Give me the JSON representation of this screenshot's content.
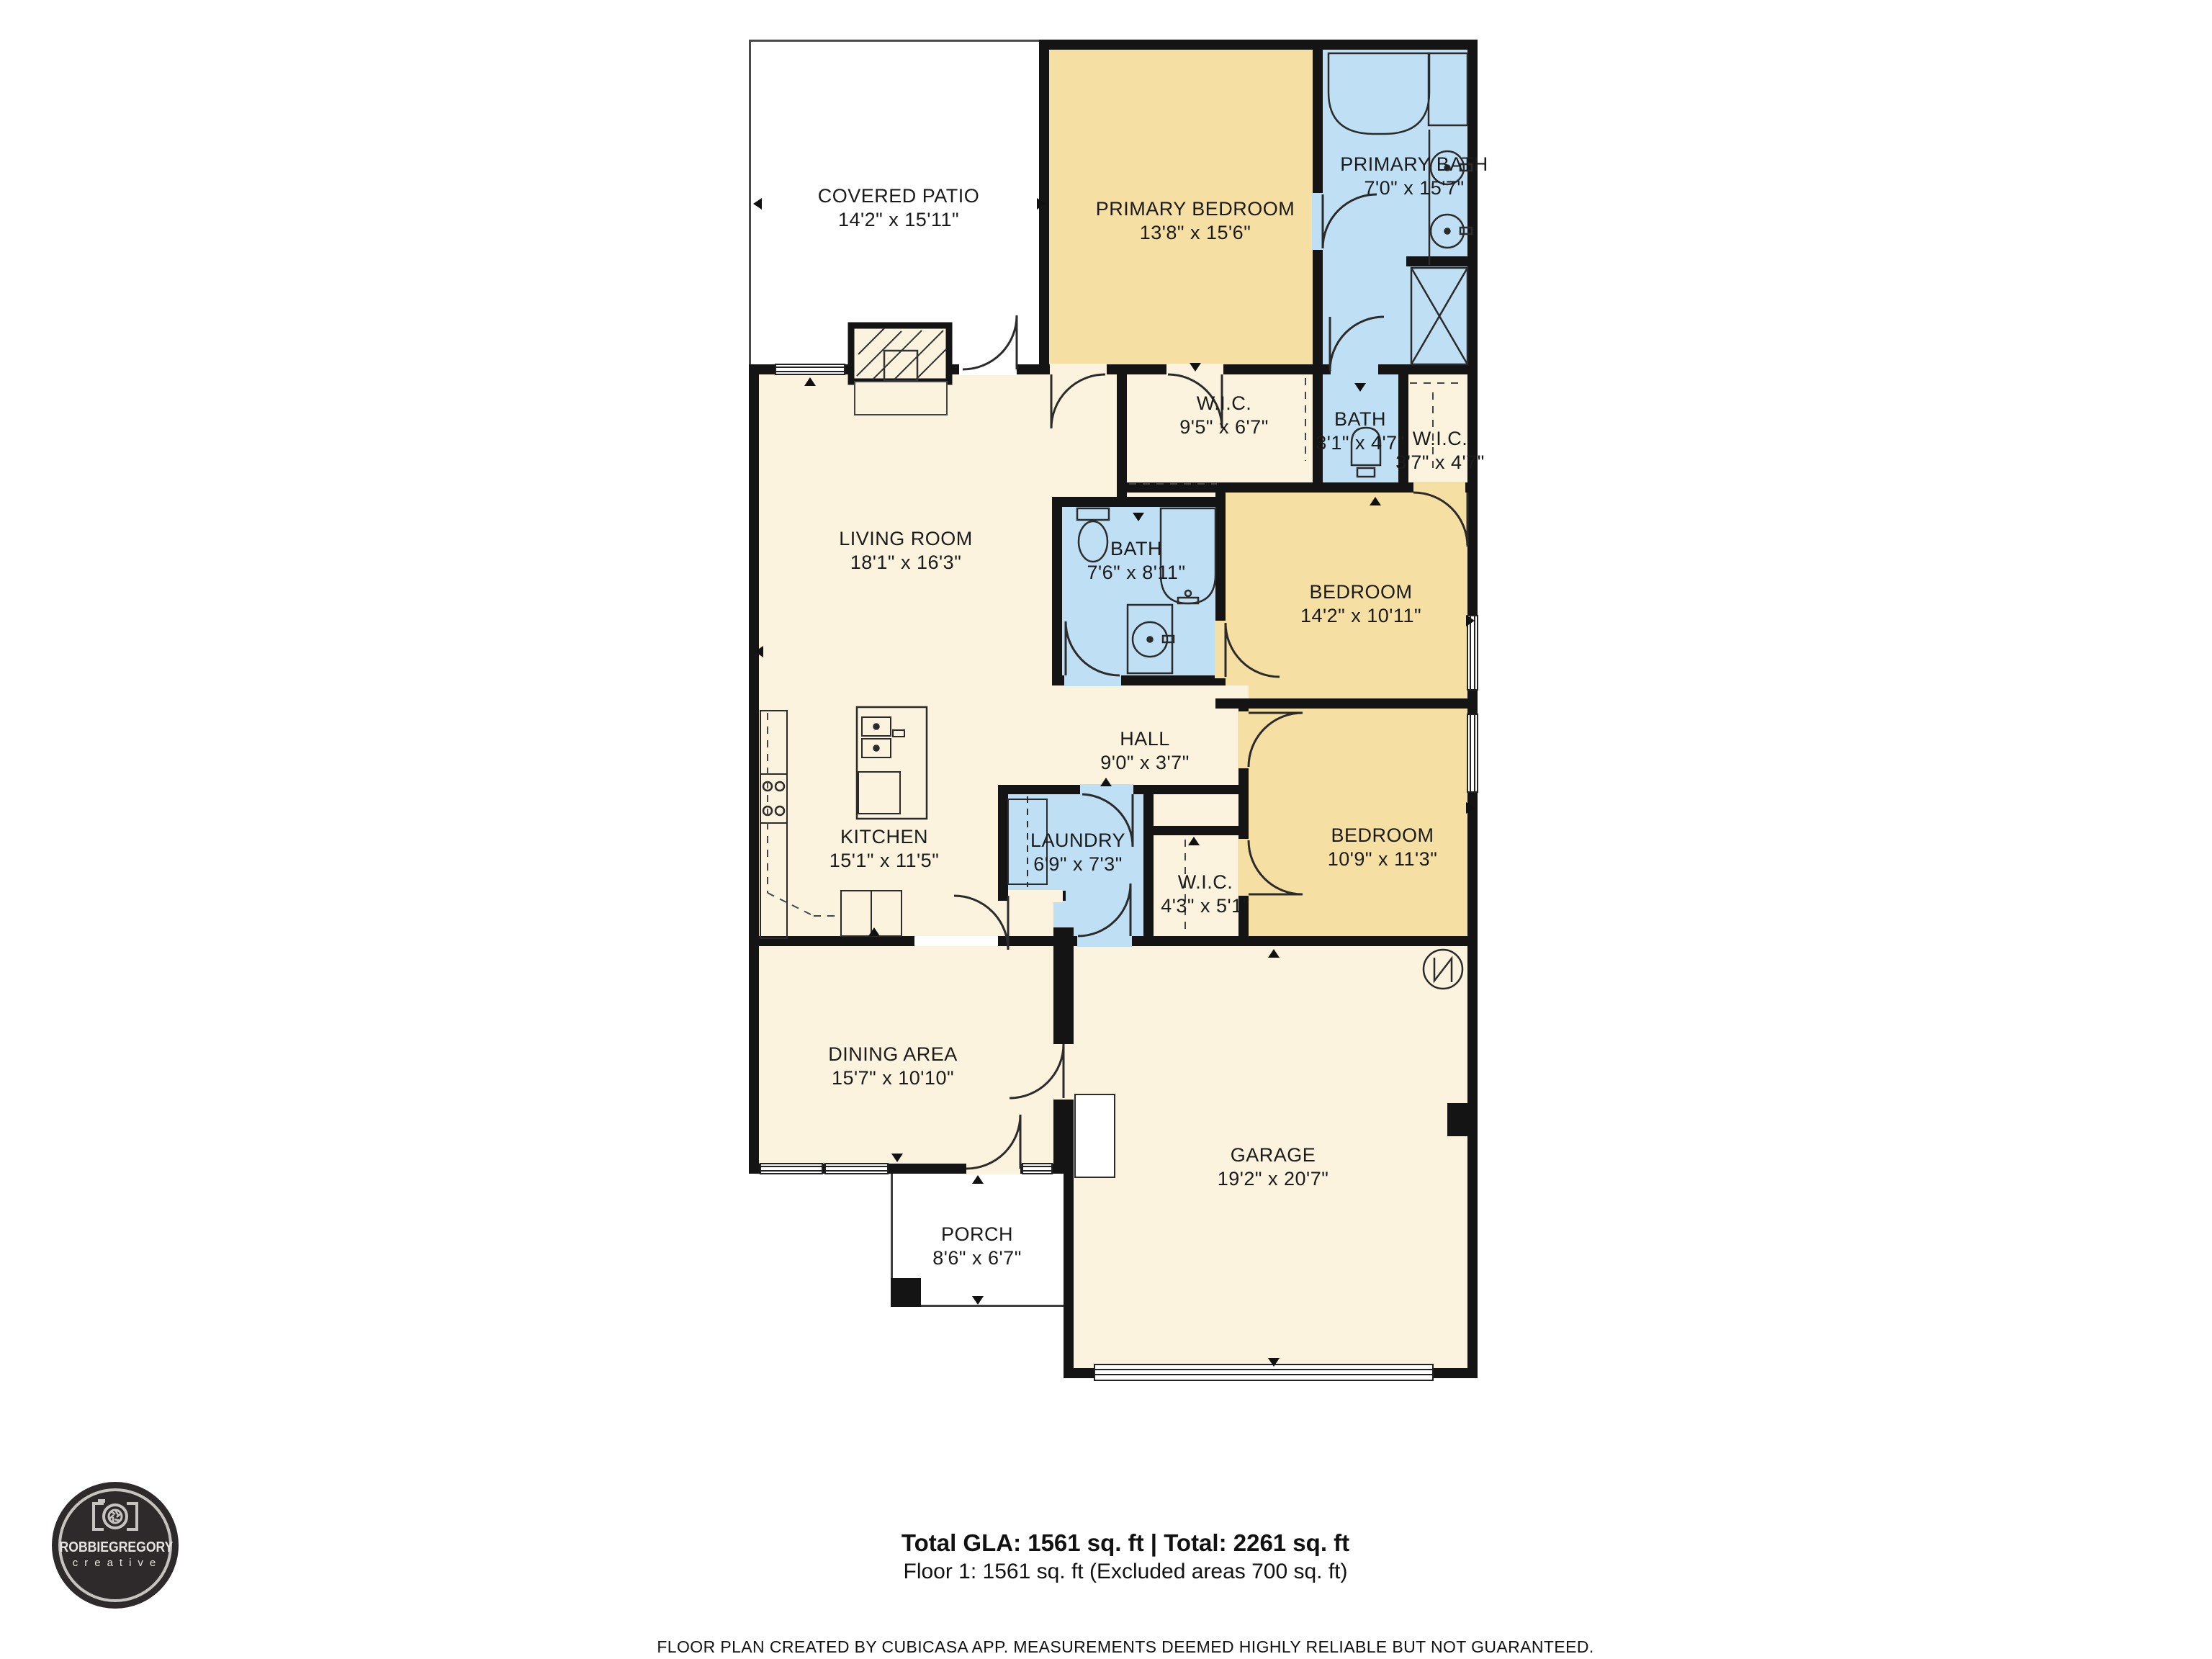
{
  "plan": {
    "rooms": [
      {
        "id": "covered_patio",
        "name": "COVERED PATIO",
        "dims": "14'2\" x 15'11\""
      },
      {
        "id": "primary_bedroom",
        "name": "PRIMARY BEDROOM",
        "dims": "13'8\" x 15'6\""
      },
      {
        "id": "primary_bath",
        "name": "PRIMARY BATH",
        "dims": "7'0\" x 15'7\""
      },
      {
        "id": "wic_primary",
        "name": "W.I.C.",
        "dims": "9'5\" x 6'7\""
      },
      {
        "id": "bath_small",
        "name": "BATH",
        "dims": "3'1\" x 4'7\""
      },
      {
        "id": "wic_small",
        "name": "W.I.C.",
        "dims": "3'7\" x 4'7\""
      },
      {
        "id": "living_room",
        "name": "LIVING ROOM",
        "dims": "18'1\" x 16'3\""
      },
      {
        "id": "bath_main",
        "name": "BATH",
        "dims": "7'6\" x 8'11\""
      },
      {
        "id": "bedroom_1",
        "name": "BEDROOM",
        "dims": "14'2\" x 10'11\""
      },
      {
        "id": "hall",
        "name": "HALL",
        "dims": "9'0\" x 3'7\""
      },
      {
        "id": "bedroom_2",
        "name": "BEDROOM",
        "dims": "10'9\" x 11'3\""
      },
      {
        "id": "laundry",
        "name": "LAUNDRY",
        "dims": "6'9\" x 7'3\""
      },
      {
        "id": "wic_bedroom2",
        "name": "W.I.C.",
        "dims": "4'3\" x 5'1\""
      },
      {
        "id": "kitchen",
        "name": "KITCHEN",
        "dims": "15'1\" x 11'5\""
      },
      {
        "id": "dining_area",
        "name": "DINING AREA",
        "dims": "15'7\" x 10'10\""
      },
      {
        "id": "porch",
        "name": "PORCH",
        "dims": "8'6\" x 6'7\""
      },
      {
        "id": "garage",
        "name": "GARAGE",
        "dims": "19'2\" x 20'7\""
      }
    ]
  },
  "summary": {
    "total_line": "Total GLA: 1561 sq. ft | Total: 2261 sq. ft",
    "floor_line": "Floor 1: 1561 sq. ft (Excluded areas 700 sq. ft)",
    "disclaimer": "FLOOR PLAN CREATED BY CUBICASA APP. MEASUREMENTS DEEMED HIGHLY RELIABLE BUT NOT GUARANTEED."
  },
  "logo": {
    "brand": "ROBBIEGREGORY",
    "sub": "creative"
  },
  "colors": {
    "room_warm": "#F6DFA3",
    "room_wet": "#BFE0F4",
    "room_common": "#FBF3DD",
    "wall": "#141414",
    "logo_bg": "#2E2A2B",
    "logo_fg": "#C6C3C0"
  }
}
